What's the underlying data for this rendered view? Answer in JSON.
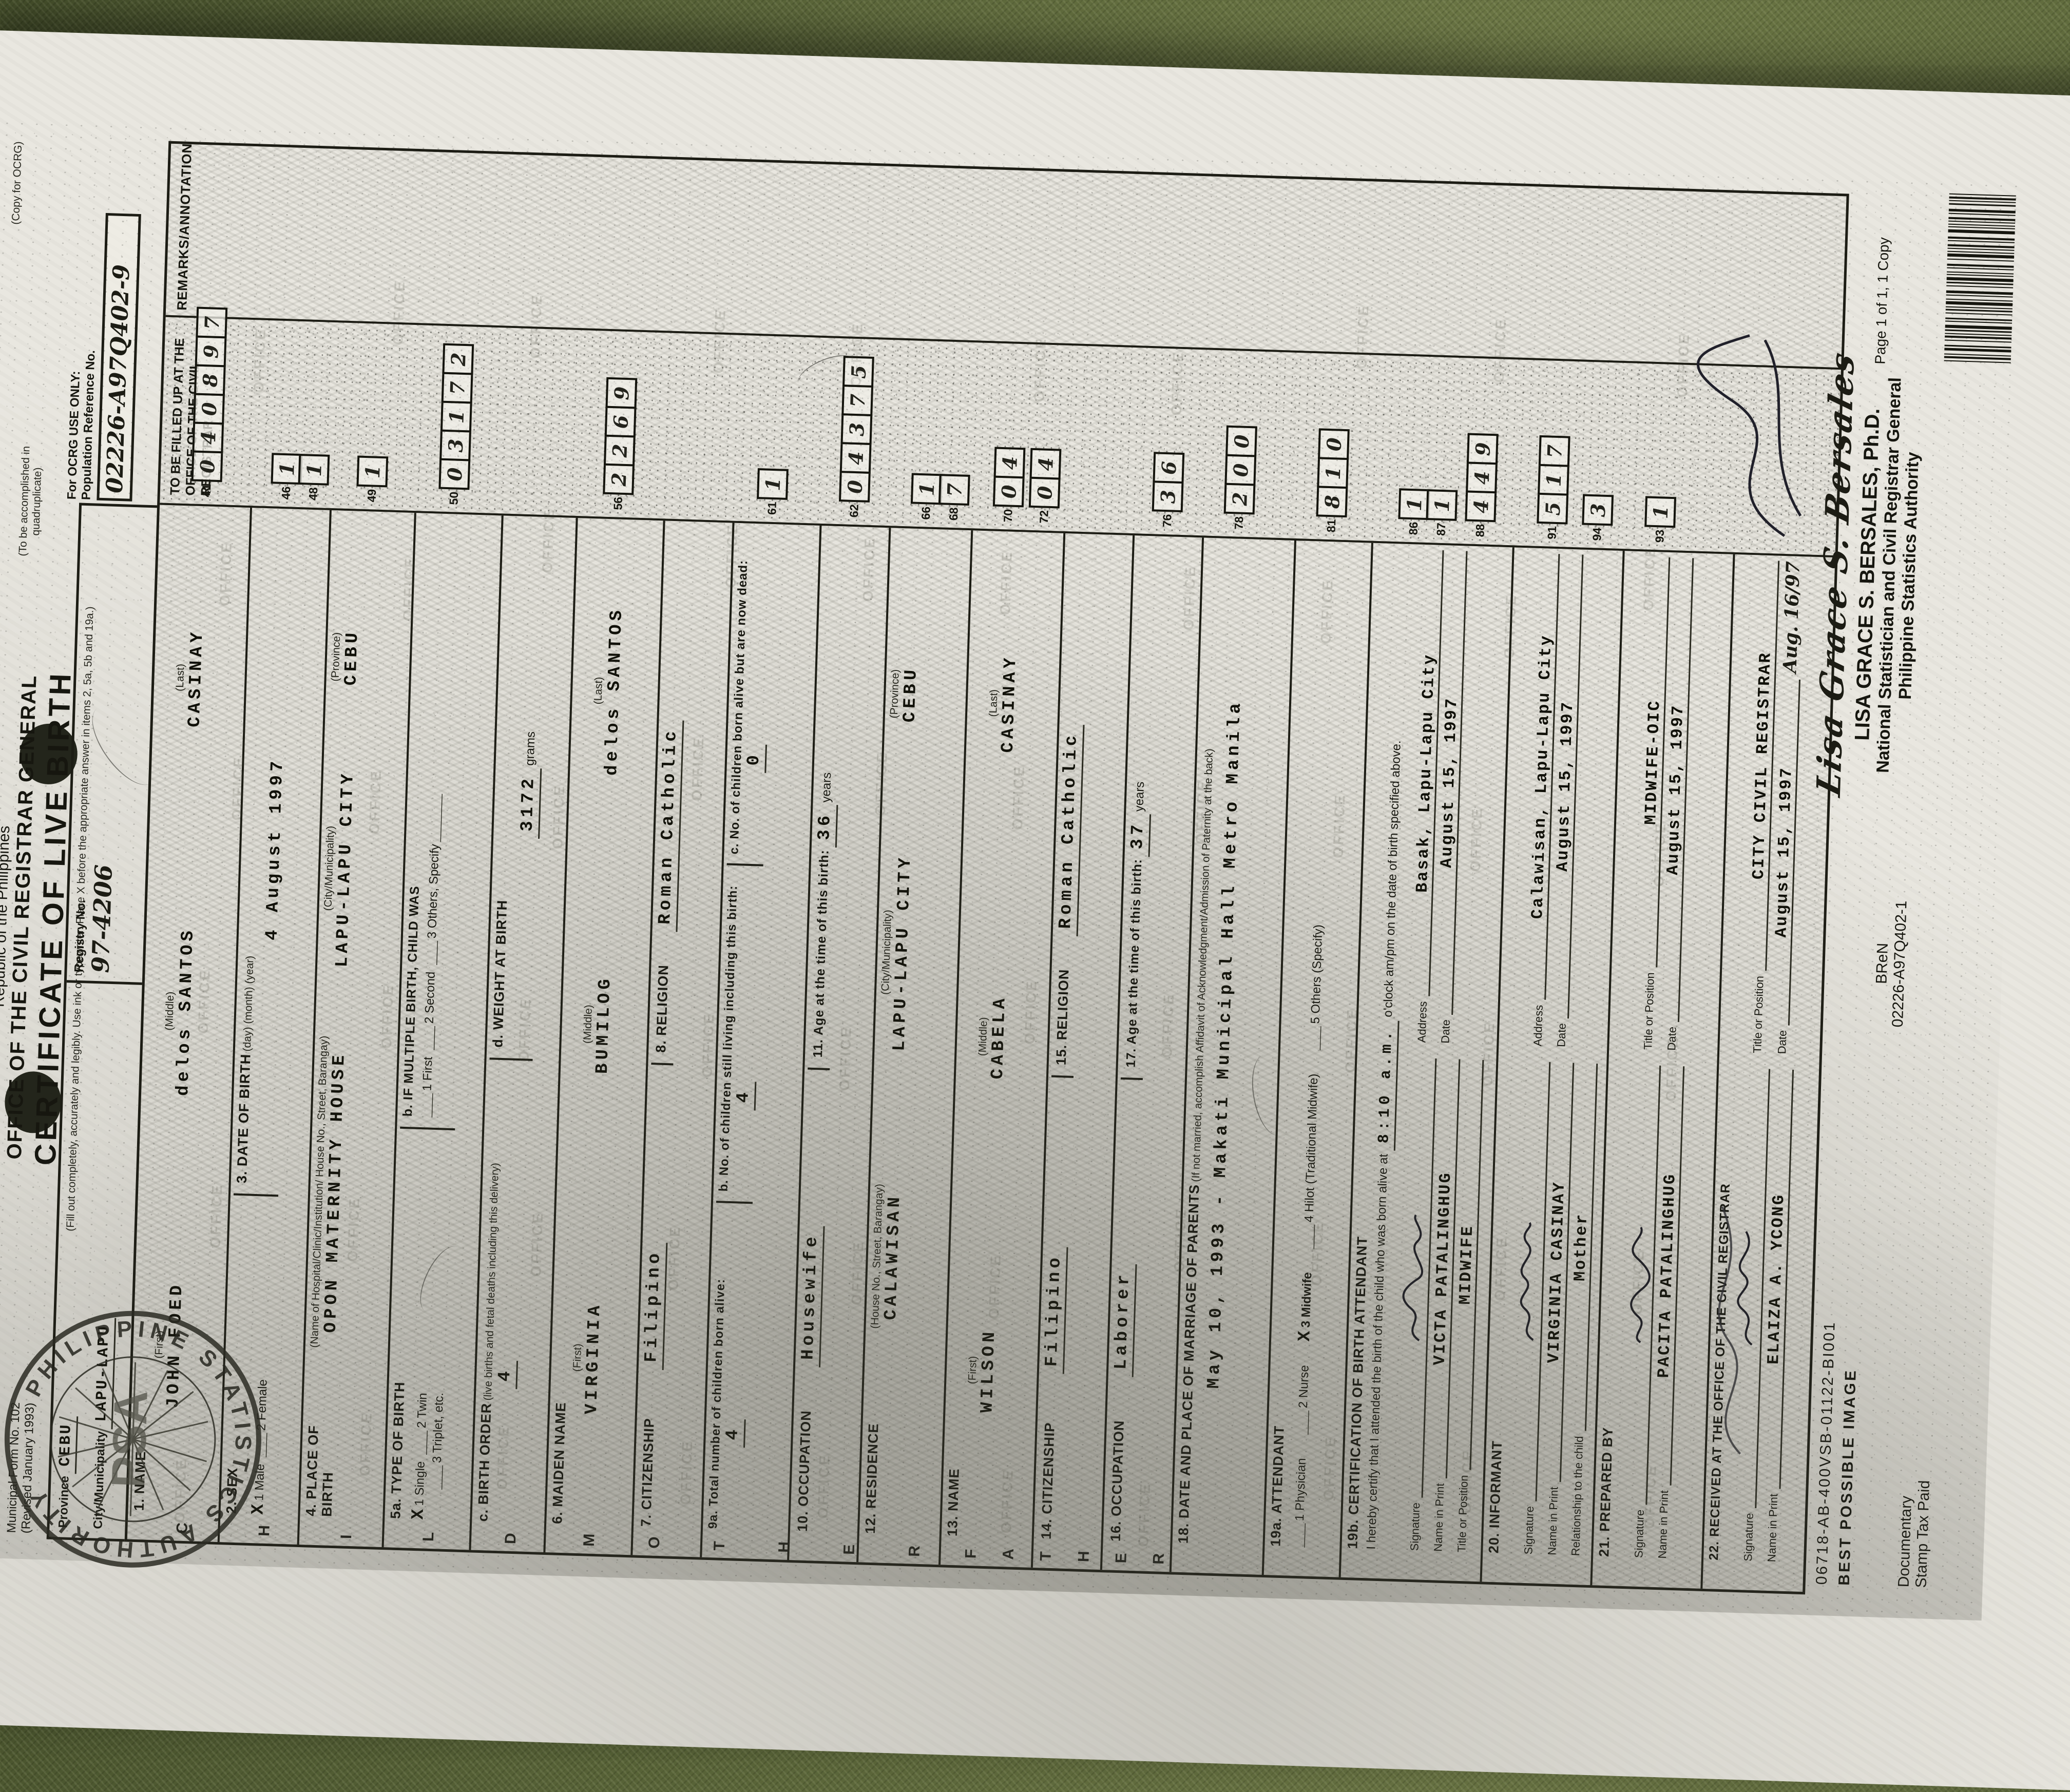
{
  "photo": {
    "page_label": "Page 1 of 1, 1 Copy",
    "copy_for": "(Copy for OCRG)"
  },
  "doc": {
    "form_no": "Municipal Form No. 102",
    "revised": "(Revised January 1993)",
    "republic": "Republic of the Philippines",
    "office": "OFFICE OF THE CIVIL REGISTRAR GENERAL",
    "title": "CERTIFICATE OF LIVE BIRTH",
    "instruction": "(Fill out completely, accurately and legibly. Use ink or typewriter. Place X before the appropriate answer in items 2, 5a, 5b and 19a.)",
    "quadruplicate": "(To be accomplished in quadruplicate)",
    "remarks_header": "REMARKS/ANNOTATION",
    "province_label": "Province",
    "province_value": "CEBU",
    "city_label": "City/Municipality",
    "city_value": "LAPU-LAPU",
    "registry_label": "Registry No.",
    "registry_value": "97-4206",
    "ocrg_only": "For OCRG USE ONLY:",
    "pop_ref": "Population Reference No.",
    "pop_ref_value": "02226-A97Q402-9",
    "fill_up": "TO BE FILLED UP AT THE OFFICE OF THE CIVIL REGISTRAR"
  },
  "rows": {
    "name": {
      "label": "1. NAME",
      "first_l": "(First)",
      "middle_l": "(Middle)",
      "last_l": "(Last)",
      "first": "JOHN FOED",
      "middle": "delos SANTOS",
      "last": "CASINAY"
    },
    "sex": {
      "label": "2. SEX",
      "mark": "X",
      "male": "1 Male",
      "female": "2 Female"
    },
    "dob": {
      "label": "3. DATE OF BIRTH",
      "sub": "(day)  (month)  (year)",
      "value": "4 August 1997"
    },
    "pob": {
      "label": "4. PLACE OF BIRTH",
      "sub1": "(Name of Hospital/Clinic/Institution/ House No., Street, Barangay)",
      "v1": "OPON MATERNITY HOUSE",
      "sub2": "(City/Municipality)",
      "v2": "LAPU-LAPU CITY",
      "sub3": "(Province)",
      "v3": "CEBU"
    },
    "tob": {
      "label": "5a. TYPE OF BIRTH",
      "mark": "X",
      "single": "1 Single",
      "twin": "2 Twin",
      "triplet": "3 Triplet, etc.",
      "b_label": "b. IF MULTIPLE BIRTH, CHILD WAS",
      "first": "1 First",
      "second": "2 Second",
      "others": "3 Others, Specify"
    },
    "order": {
      "label": "c. BIRTH ORDER",
      "note": "(live births and fetal deaths including this delivery)",
      "value": "4",
      "w_label": "d. WEIGHT AT BIRTH",
      "weight": "3172",
      "grams": "grams"
    },
    "maiden": {
      "label": "6. MAIDEN NAME",
      "first_l": "(First)",
      "middle_l": "(Middle)",
      "last_l": "(Last)",
      "first": "VIRGINIA",
      "middle": "BUMILOG",
      "last": "delos SANTOS"
    },
    "cit_m": {
      "label": "7. CITIZENSHIP",
      "value": "Filipino",
      "rel_label": "8. RELIGION",
      "rel_value": "Roman Catholic"
    },
    "children": {
      "label": "9a. Total number of children born alive:",
      "a": "4",
      "b_label": "b. No. of children still living including this birth:",
      "b": "4",
      "c_label": "c. No. of children born alive but are now dead:",
      "c": "0"
    },
    "occ_m": {
      "label": "10. OCCUPATION",
      "value": "Housewife",
      "age_label": "11. Age at the time of this birth:",
      "age": "36",
      "years": "years"
    },
    "res": {
      "label": "12. RESIDENCE",
      "sub1": "(House No., Street, Barangay)",
      "v1": "CALAWISAN",
      "sub2": "(City/Municipality)",
      "v2": "LAPU-LAPU CITY",
      "sub3": "(Province)",
      "v3": "CEBU"
    },
    "name_f": {
      "label": "13. NAME",
      "first_l": "(First)",
      "middle_l": "(Middle)",
      "last_l": "(Last)",
      "first": "WILSON",
      "middle": "CABELA",
      "last": "CASINAY"
    },
    "cit_f": {
      "label": "14. CITIZENSHIP",
      "value": "Filipino",
      "rel_label": "15. RELIGION",
      "rel_value": "Roman Catholic"
    },
    "occ_f": {
      "label": "16. OCCUPATION",
      "value": "Laborer",
      "age_label": "17. Age at the time of this birth:",
      "age": "37",
      "years": "years"
    },
    "marriage": {
      "label": "18. DATE AND PLACE OF MARRIAGE OF PARENTS",
      "note": "(If not married, accomplish Affidavit of Acknowledgment/Admission of Paternity at the back)",
      "value": "May 10, 1993 - Makati Municipal Hall Metro Manila"
    },
    "attendant": {
      "label": "19a. ATTENDANT",
      "mark": "X",
      "o1": "1 Physician",
      "o2": "2 Nurse",
      "o3": "3 Midwife",
      "o4": "4 Hilot (Traditional Midwife)",
      "o5": "5 Others (Specify)"
    },
    "cert": {
      "label": "19b. CERTIFICATION OF BIRTH ATTENDANT",
      "text1": "I hereby certify that I attended the birth of the child who was born alive at",
      "time": "8:10 a.m.",
      "text2": "o'clock am/pm on the date of birth specified above.",
      "sig_l": "Signature",
      "name_l": "Name in Print",
      "name": "VICTA PATALINGHUG",
      "title_l": "Title or Position",
      "title": "MIDWIFE",
      "addr_l": "Address",
      "addr": "Basak, Lapu-Lapu City",
      "date_l": "Date",
      "date": "August 15, 1997"
    },
    "informant": {
      "label": "20. INFORMANT",
      "sig_l": "Signature",
      "name_l": "Name in Print",
      "name": "VIRGINIA CASINAY",
      "rel_l": "Relationship to the child",
      "rel": "Mother",
      "addr_l": "Address",
      "addr": "Calawisan, Lapu-Lapu City",
      "date_l": "Date",
      "date": "August 15, 1997"
    },
    "prepared": {
      "label": "21. PREPARED BY",
      "sig_l": "Signature",
      "name_l": "Name in Print",
      "name": "PACITA PATALINGHUG",
      "title_l": "Title or Position",
      "title": "MIDWIFE-OIC",
      "date_l": "Date",
      "date": "August 15, 1997"
    },
    "received": {
      "label": "22. RECEIVED AT THE OFFICE OF THE CIVIL REGISTRAR",
      "sig_l": "Signature",
      "name_l": "Name in Print",
      "name": "ELAIZA A. YCONG",
      "title_l": "Title or Position",
      "title": "CITY CIVIL REGISTRAR",
      "date_l": "Date",
      "date": "August 15, 1997",
      "script_date": "Aug. 16/97"
    }
  },
  "sections": [
    {
      "word": "CHILD"
    },
    {
      "word": "MOTHER"
    },
    {
      "word": "FATHER"
    }
  ],
  "ocrg_boxes": [
    {
      "no": "41",
      "cells": [
        "0",
        "4",
        "0",
        "8",
        "9",
        "7"
      ]
    },
    {
      "no": "46",
      "cells": [
        "1"
      ]
    },
    {
      "no": "48",
      "cells": [
        "1"
      ]
    },
    {
      "no": "49",
      "cells": [
        "1"
      ]
    },
    {
      "no": "50",
      "cells": [
        "0",
        "3",
        "1",
        "7",
        "2"
      ]
    },
    {
      "no": "56",
      "cells": [
        "2",
        "2",
        "6",
        "9"
      ]
    },
    {
      "no": "61",
      "cells": [
        "1"
      ]
    },
    {
      "no": "62",
      "cells": [
        "0",
        "4",
        "3",
        "7",
        "5"
      ]
    },
    {
      "no": "66",
      "cells": [
        "1"
      ]
    },
    {
      "no": "68",
      "cells": [
        "7"
      ]
    },
    {
      "no": "70",
      "cells": [
        "0",
        "4"
      ]
    },
    {
      "no": "72",
      "cells": [
        "0",
        "4"
      ]
    },
    {
      "no": "76",
      "cells": [
        "3",
        "6"
      ]
    },
    {
      "no": "78",
      "cells": [
        "2",
        "0",
        "0"
      ]
    },
    {
      "no": "81",
      "cells": [
        "8",
        "1",
        "0"
      ]
    },
    {
      "no": "86",
      "cells": [
        "1"
      ]
    },
    {
      "no": "87",
      "cells": [
        "1"
      ]
    },
    {
      "no": "88",
      "cells": [
        "4",
        "4",
        "9"
      ]
    },
    {
      "no": "91",
      "cells": [
        "5",
        "1",
        "7"
      ]
    },
    {
      "no": "93",
      "cells": [
        "1"
      ]
    },
    {
      "no": "94",
      "cells": [
        "3"
      ]
    }
  ],
  "bottom": {
    "serial": "06718-AB-400VSB-01122-BI001",
    "best_possible": "BEST POSSIBLE IMAGE",
    "documentary1": "Documentary",
    "documentary2": "Stamp Tax Paid",
    "bren": "BReN",
    "bren_no": "02226-A97Q402-1",
    "bersales_script": "Lisa Grace S. Bersales",
    "bersales_name": "LISA GRACE S. BERSALES, Ph.D.",
    "bersales_title1": "National Statistician and Civil Registrar General",
    "bersales_title2": "Philippine Statistics Authority"
  },
  "seal": {
    "ring_text": "PHILIPPINE STATISTICS AUTHORITY",
    "center_text": "PSA"
  },
  "watermark": "OFFICE",
  "colors": {
    "paper": "#e9e7e0",
    "ink": "#16160f",
    "fabric": "#4f5a33"
  }
}
